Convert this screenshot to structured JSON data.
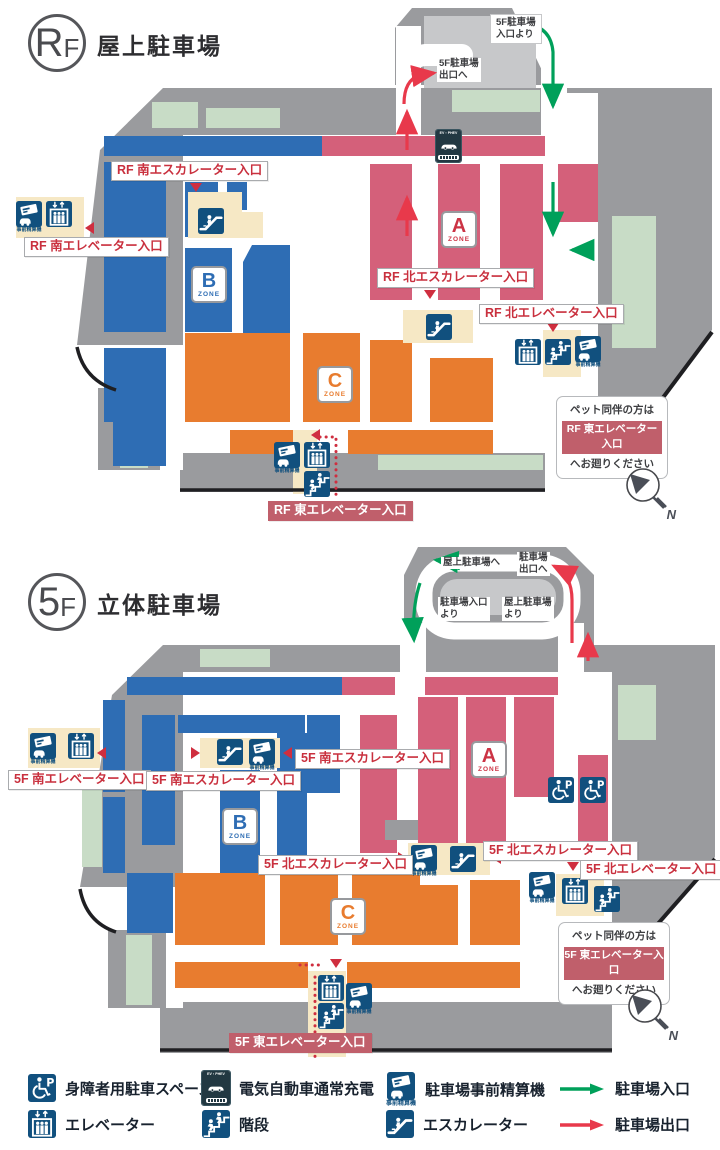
{
  "rf": {
    "badge": {
      "big": "R",
      "small": "F"
    },
    "title": "屋上駐車場",
    "ramp": {
      "from_5f_entrance": "5F駐車場\n入口より",
      "to_5f_exit": "5F駐車場\n出口へ"
    },
    "labels": {
      "south_escalator": "RF 南エスカレーター入口",
      "south_elevator": "RF 南エレベーター入口",
      "north_escalator": "RF 北エスカレーター入口",
      "north_elevator": "RF 北エレベーター入口",
      "east_elevator": "RF 東エレベーター入口"
    },
    "pet_note": {
      "line1": "ペット同伴の方は",
      "line2": "RF 東エレベーター入口",
      "line3": "へお廻りください"
    }
  },
  "f5": {
    "badge": {
      "big": "5",
      "small": "F"
    },
    "title": "立体駐車場",
    "ramp": {
      "to_roof": "屋上駐車場へ",
      "to_exit": "駐車場\n出口へ",
      "from_entrance": "駐車場入口\nより",
      "from_roof": "屋上駐車場\nより"
    },
    "labels": {
      "south_escalator": "5F 南エスカレーター入口",
      "south_elevator": "5F 南エレベーター入口",
      "north_escalator": "5F 北エスカレーター入口",
      "north_elevator": "5F 北エレベーター入口",
      "east_elevator": "5F 東エレベーター入口"
    },
    "pet_note": {
      "line1": "ペット同伴の方は",
      "line2": "5F 東エレベーター入口",
      "line3": "へお廻りください"
    }
  },
  "zones": {
    "a": {
      "letter": "A",
      "word": "ZONE"
    },
    "b": {
      "letter": "B",
      "word": "ZONE"
    },
    "c": {
      "letter": "C",
      "word": "ZONE"
    }
  },
  "icons": {
    "ev_label": "EV・PHEV",
    "payment_caption": "事前精算機",
    "compass_n": "N"
  },
  "legend": {
    "items": [
      {
        "icon": "wheelchair-parking-icon",
        "label": "身障者用駐車スペース"
      },
      {
        "icon": "ev-charging-icon",
        "label": "電気自動車通常充電"
      },
      {
        "icon": "payment-machine-icon",
        "label": "駐車場事前精算機"
      },
      {
        "icon": "entrance-arrow-icon",
        "label": "駐車場入口"
      },
      {
        "icon": "elevator-icon",
        "label": "エレベーター"
      },
      {
        "icon": "stairs-icon",
        "label": "階段"
      },
      {
        "icon": "escalator-icon",
        "label": "エスカレーター"
      },
      {
        "icon": "exit-arrow-icon",
        "label": "駐車場出口"
      }
    ]
  },
  "colors": {
    "blue": "#2e6db4",
    "pink": "#d4607a",
    "orange": "#e87c2f",
    "gray": "#9a9b9e",
    "light_gray": "#c7c8ca",
    "pale_green": "#c8dcc6",
    "cream": "#f6e8c5",
    "navy": "#11507e",
    "label_red": "#c9303e",
    "solid_label_bg": "#c05f6b",
    "green_arrow": "#00a05a",
    "red_arrow": "#e8394b"
  }
}
